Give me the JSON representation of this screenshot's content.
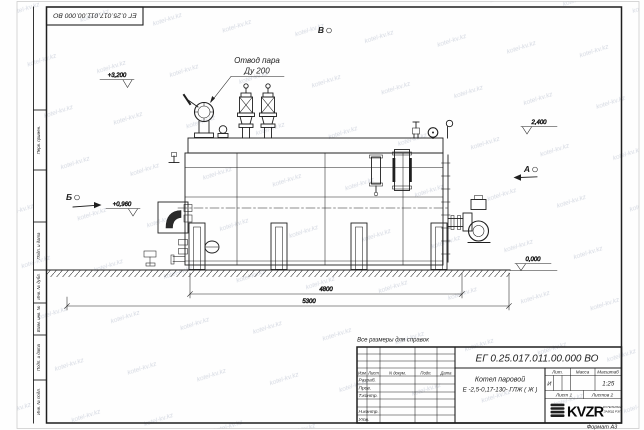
{
  "watermark": {
    "text": "kotel-kv.kz"
  },
  "frame": {
    "sidebar_labels": {
      "perv": "Перв. примен.",
      "podp1": "Подп. и дата",
      "inv_dubl": "Инв. № дубл.",
      "vzam": "Взам. инв. №",
      "podp2": "Подп. и дата",
      "inv_podl": "Инв. № подл."
    },
    "format_note": "Формат А3"
  },
  "drawing": {
    "note": "Все размеры для справок",
    "callout": {
      "line1": "Отвод пара",
      "line2": "Ду 200"
    },
    "elevations": {
      "e3200": "+3,200",
      "e2400": "2,400",
      "e0960": "+0,960",
      "e0000": "0,000"
    },
    "sections": {
      "b": "Б",
      "a": "А",
      "v": "В"
    },
    "dims": {
      "d4800": "4800",
      "d5300": "5300"
    }
  },
  "title_block": {
    "designation": "ЕГ 0.25.017.011.00.000  ВО",
    "product_name_1": "Котел паровой",
    "product_name_2": "Е -2,5-0,17-130- ГЛЖ ( Ж )",
    "col_headers": {
      "izm": "Изм",
      "list": "Лист",
      "doc": "N докум.",
      "sign": "Подп.",
      "date": "Дата"
    },
    "row_labels": {
      "razrab": "Разраб.",
      "prov": "Пров.",
      "tkontr": "Т.контр.",
      "nkontr": "Н.контр.",
      "utv": "Утв."
    },
    "props": {
      "lit_h": "Лит.",
      "mass_h": "Масса",
      "scale_h": "Масштаб",
      "lit": "И",
      "scale": "1:25"
    },
    "sheets": {
      "sheet": "Лист 1",
      "total": "Листов 2"
    },
    "logo": {
      "text": "KVZR",
      "caption1": "КОТЕЛЬНЫЙ",
      "caption2": "ЗАВОД РЭП"
    }
  }
}
